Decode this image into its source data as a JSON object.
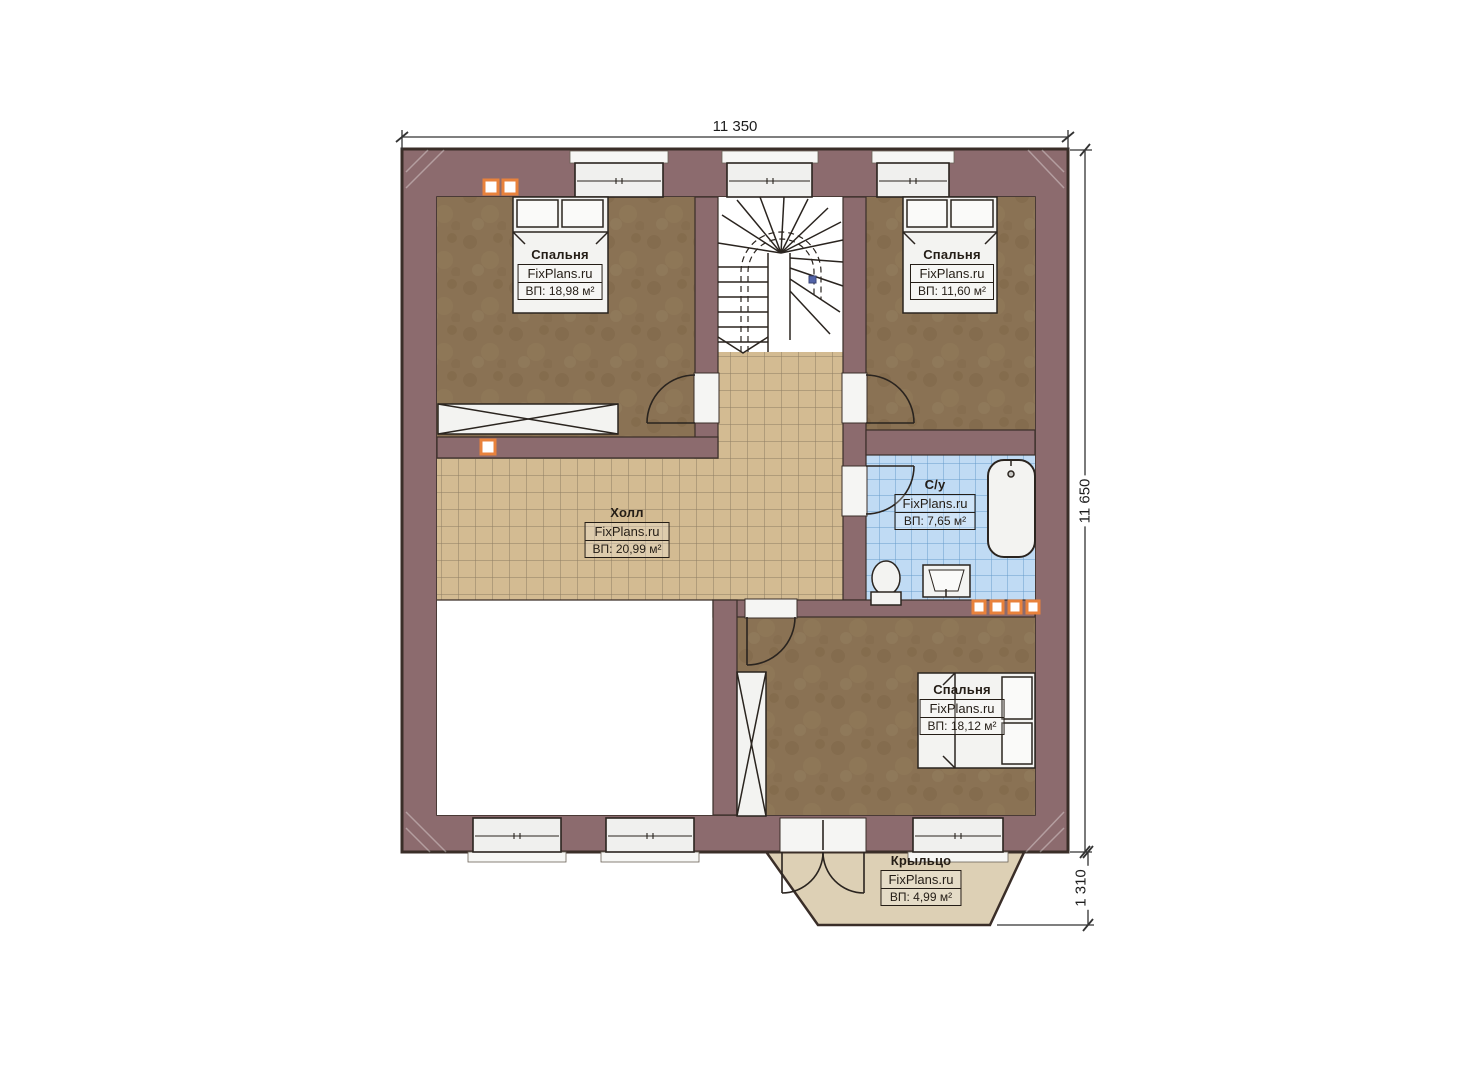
{
  "plan": {
    "brand": "FixPlans.ru",
    "dimensions": {
      "top": "11 350",
      "right": "11 650",
      "porch": "1 310"
    },
    "rooms": {
      "bedroom_top_left": {
        "name": "Спальня",
        "area": "ВП: 18,98 м²"
      },
      "bedroom_top_right": {
        "name": "Спальня",
        "area": "ВП: 11,60 м²"
      },
      "hall": {
        "name": "Холл",
        "area": "ВП: 20,99 м²"
      },
      "bathroom": {
        "name": "С/у",
        "area": "ВП: 7,65 м²"
      },
      "bedroom_bottom": {
        "name": "Спальня",
        "area": "ВП: 18,12 м²"
      },
      "porch": {
        "name": "Крыльцо",
        "area": "ВП: 4,99 м²"
      }
    },
    "colors": {
      "wall": "#8c6b6e",
      "outline": "#3a2e28",
      "carpet": "#8a7254",
      "hall_tile": "#d3bb92",
      "bath_tile": "#c0dbf4",
      "porch_floor": "#ddd0b5",
      "window_fill": "#f0f0ee",
      "accent_orange": "#e8823c"
    }
  }
}
